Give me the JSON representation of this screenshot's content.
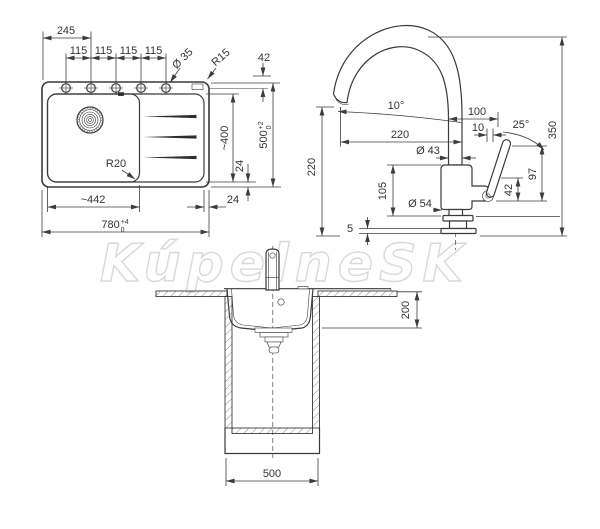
{
  "watermark": {
    "text": "KúpelneSK"
  },
  "plan": {
    "hole_offset": "245",
    "hole_pitch_1": "115",
    "hole_pitch_2": "115",
    "hole_pitch_3": "115",
    "hole_pitch_4": "115",
    "hole_diameter": "Ø 35",
    "corner_radius": "R15",
    "rim_offset_top": "42",
    "drainer_length": "~400",
    "rim_width_vertical": "24",
    "overall_depth": "500",
    "overall_depth_tol_plus": "+2",
    "overall_depth_tol_minus": "0",
    "rim_width_horizontal": "24",
    "bowl_width": "~442",
    "overall_width": "780",
    "overall_width_tol_plus": "+4",
    "overall_width_tol_minus": "0",
    "bowl_corner_radius": "R20"
  },
  "faucet": {
    "spout_angle": "10°",
    "spout_reach": "220",
    "spout_outlet_height": "220",
    "overall_height": "350",
    "handle_reach": "100",
    "handle_offset": "10",
    "handle_angle": "25°",
    "body_diameter": "Ø 43",
    "body_height": "105",
    "handle_top_height": "97",
    "handle_pivot_height": "42",
    "base_diameter": "Ø 54",
    "base_plate_thickness": "5"
  },
  "section": {
    "bowl_depth": "200",
    "cabinet_width": "500"
  }
}
